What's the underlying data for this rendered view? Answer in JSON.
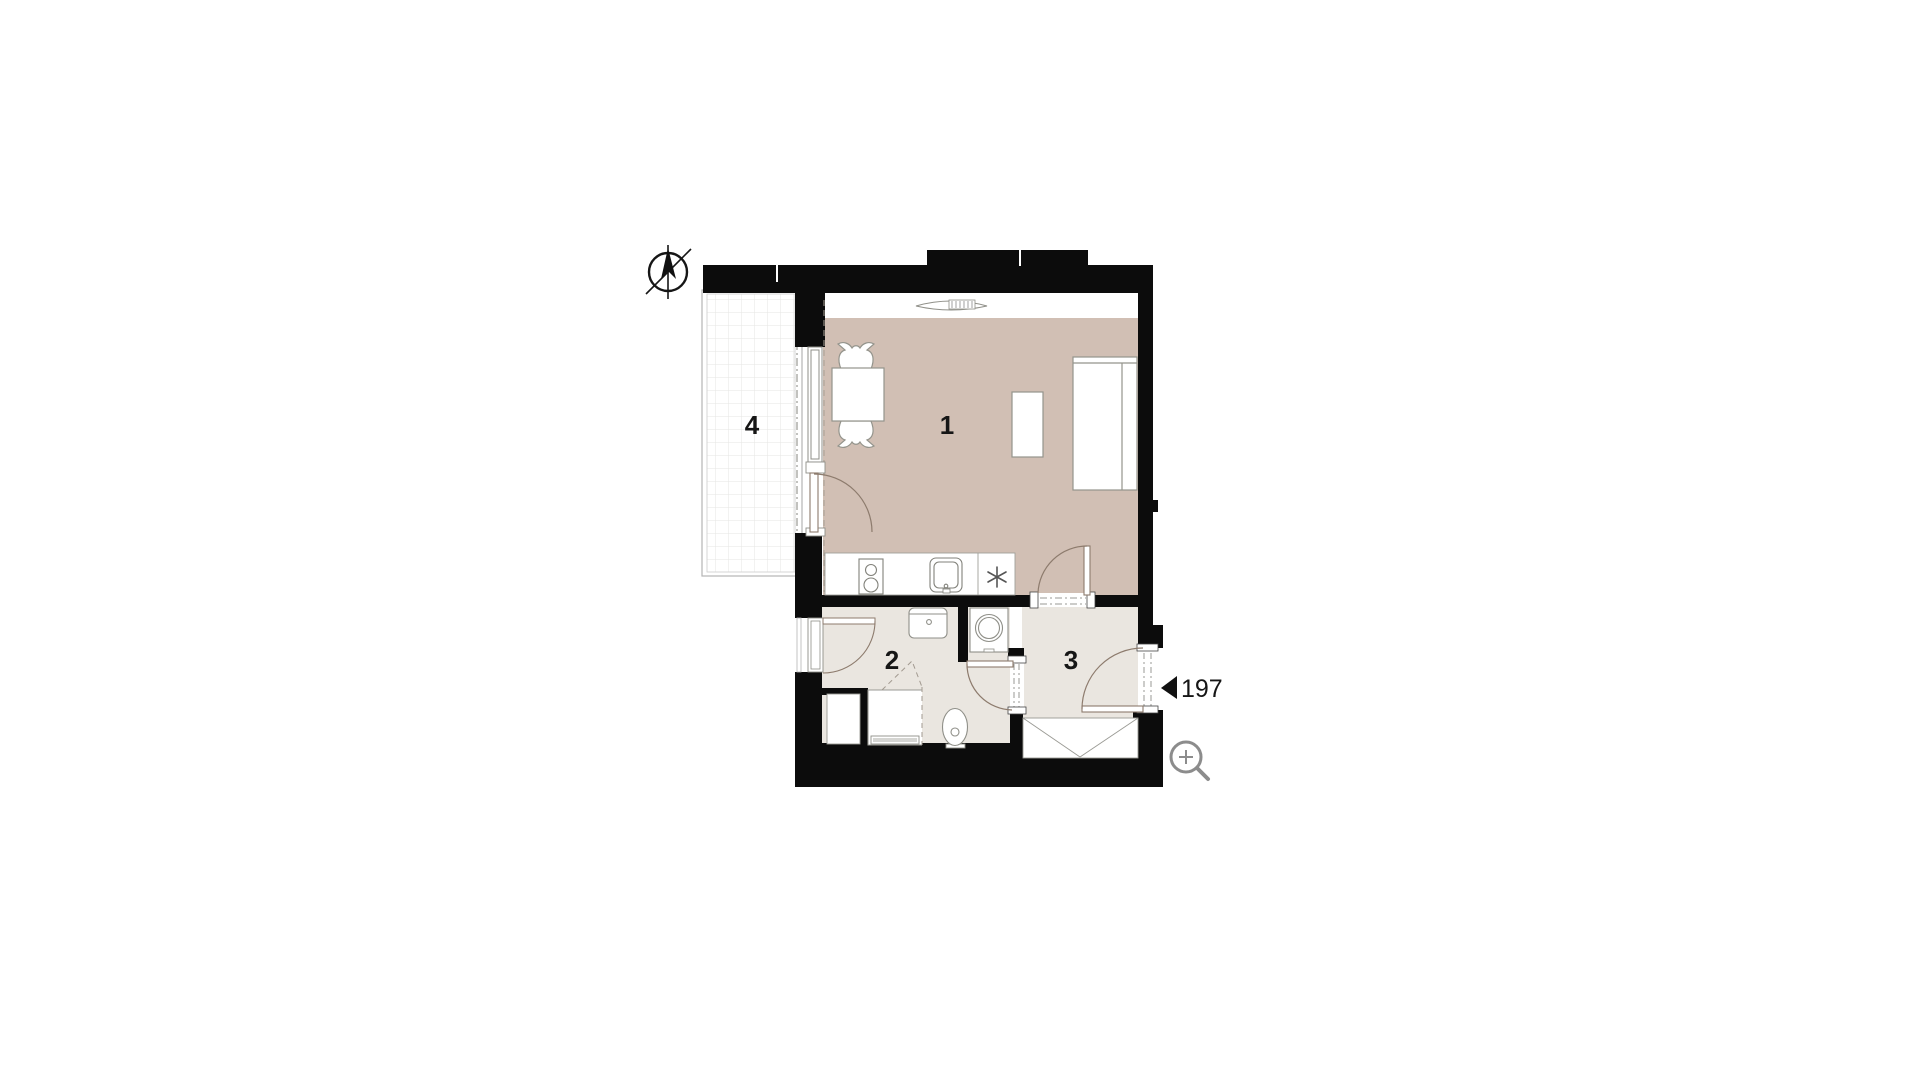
{
  "floor_plan": {
    "rooms": [
      {
        "id": "living-room",
        "label": "1"
      },
      {
        "id": "bathroom",
        "label": "2"
      },
      {
        "id": "hall",
        "label": "3"
      },
      {
        "id": "balcony",
        "label": "4"
      }
    ],
    "entrance_marker": {
      "label": "197"
    },
    "icons": {
      "compass": "north-compass-icon",
      "magnifier": "zoom-icon"
    },
    "colors": {
      "living_floor": "#d1bfb4",
      "service_floor": "#eae6e0",
      "wall": "#0c0c0c",
      "door_swing": "#8d7b6d",
      "furniture_stroke": "#94948c",
      "dashdot": "#9a9a94",
      "icon_gray": "#8c8c8c",
      "label": "#161616"
    }
  }
}
